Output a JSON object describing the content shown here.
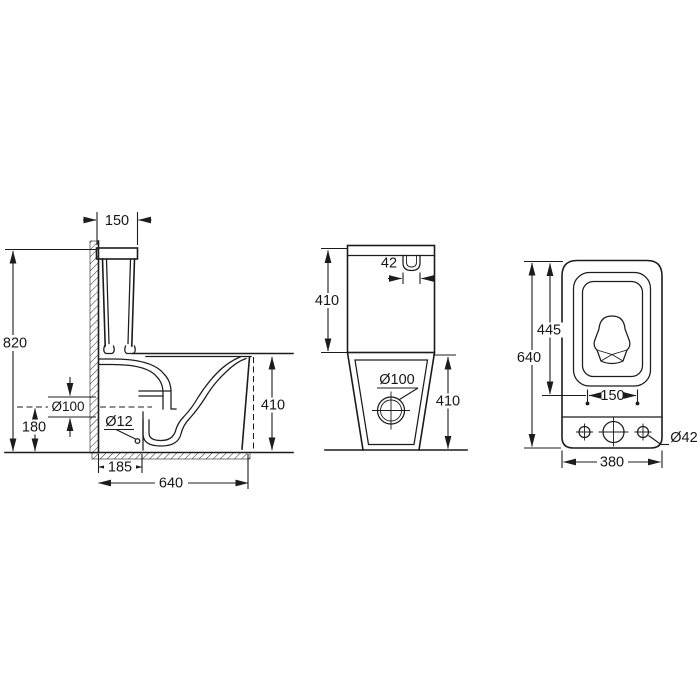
{
  "colors": {
    "ink": "#1c1c1c",
    "background": "#ffffff"
  },
  "views": {
    "side": {
      "name": "side-section-view",
      "dims": {
        "tank_width": "150",
        "overall_height": "820",
        "outlet_diameter": "Ø100",
        "outlet_center_height": "180",
        "fixing_hole_diameter": "Ø12",
        "outlet_offset": "185",
        "overall_depth": "640",
        "bowl_height": "410"
      }
    },
    "front": {
      "name": "front-view",
      "dims": {
        "button_width": "42",
        "tank_height": "410",
        "drain_diameter": "Ø100",
        "base_height": "410"
      }
    },
    "top": {
      "name": "top-view",
      "dims": {
        "seat_depth": "445",
        "overall_depth": "640",
        "hinge_spacing": "150",
        "hole_diameter": "Ø42",
        "tank_width": "380"
      }
    }
  }
}
